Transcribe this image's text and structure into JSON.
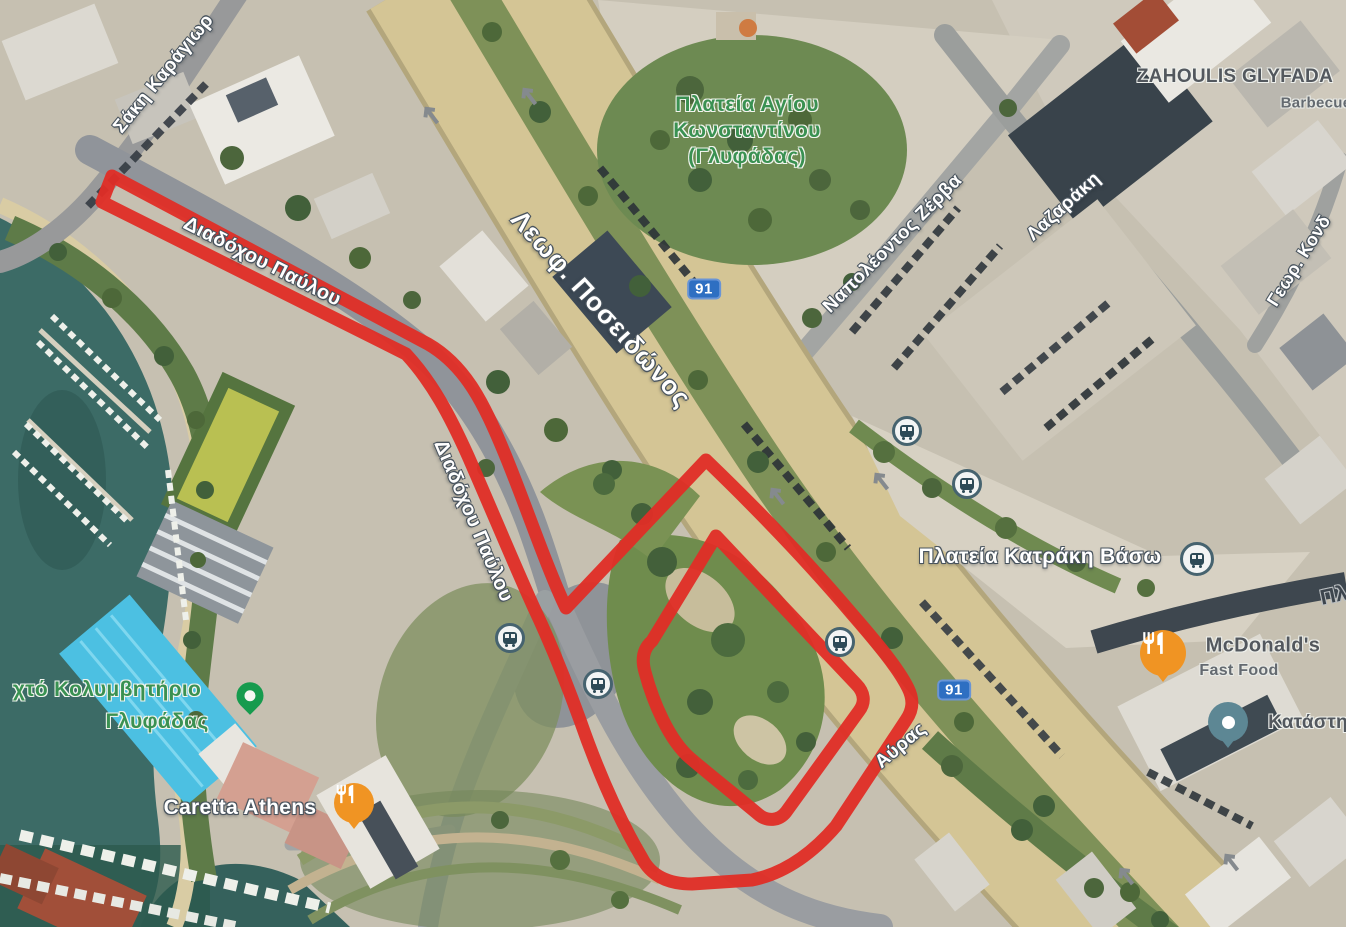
{
  "map_type": "satellite-with-annotations",
  "labels": {
    "saki": {
      "text": "Σάκη Καράγιωρ"
    },
    "diadochou_1": {
      "text": "Διαδόχου Παύλου"
    },
    "diadochou_2": {
      "text": "Διαδόχου Παύλου"
    },
    "poseidonos": {
      "text": "Λεωφ. Ποσειδώνος"
    },
    "plateia_agiou": {
      "line1": "Πλατεία Αγίου",
      "line2": "Κωνσταντίνου",
      "line3": "(Γλυφάδας)"
    },
    "zerva": {
      "text": "Ναπολέοντος Ζέρβα"
    },
    "lazaraki": {
      "text": "Λαζαράκη"
    },
    "zahoulis": {
      "title": "ZAHOULIS GLYFADA",
      "subtitle": "Barbecue"
    },
    "geor_kond": {
      "text": "Γεωρ. Κονδ"
    },
    "katraki": {
      "text": "Πλατεία Κατράκη Βάσω"
    },
    "mcdonalds": {
      "title": "McDonald's",
      "subtitle": "Fast Food"
    },
    "katastima": {
      "text": "Κατάστη"
    },
    "kolymvitirio": {
      "line1": "χτό Κολυμβητήριο",
      "line2": "Γλυφάδας"
    },
    "caretta": {
      "text": "Caretta Athens"
    },
    "avras": {
      "text": "Αύρας"
    },
    "pl_fragment": {
      "text": "Πλ"
    }
  },
  "route_badges": {
    "badge_1": "91",
    "badge_2": "91"
  },
  "icons": [
    "bus-stop-icon",
    "restaurant-icon",
    "store-icon",
    "place-pin-icon",
    "road-arrow-icon"
  ],
  "colors": {
    "annotation_red": "#e02d26",
    "route_badge_blue": "#2e6fc2",
    "poi_food_orange": "#f09423",
    "poi_store_teal": "#5d8794",
    "place_pin_green": "#169b4e",
    "area_label_green": "#3a9152",
    "water_teal": "#3c6b66",
    "avenue_tan": "#d4c595"
  },
  "red_overlay": {
    "outer_d": "M 112,176 L 428,344 C 466,366 484,404 504,452 C 524,500 546,566 566,608 L 706,460 C 760,512 808,562 852,614 C 878,644 898,668 908,688 C 914,700 913,710 906,720 L 836,826 C 810,856 782,874 752,880 L 692,884 C 666,884 650,874 642,858 C 616,814 596,766 580,720 C 564,676 550,642 534,608 C 514,564 490,506 468,456 C 450,416 432,382 406,354 L 102,202 Z",
    "inner_d": "M 716,536 L 856,684 C 864,692 866,702 859,711 L 786,812 C 779,821 767,822 758,814 C 734,794 711,776 690,758 C 669,740 653,702 645,672 C 641,658 644,648 652,641 Z"
  }
}
